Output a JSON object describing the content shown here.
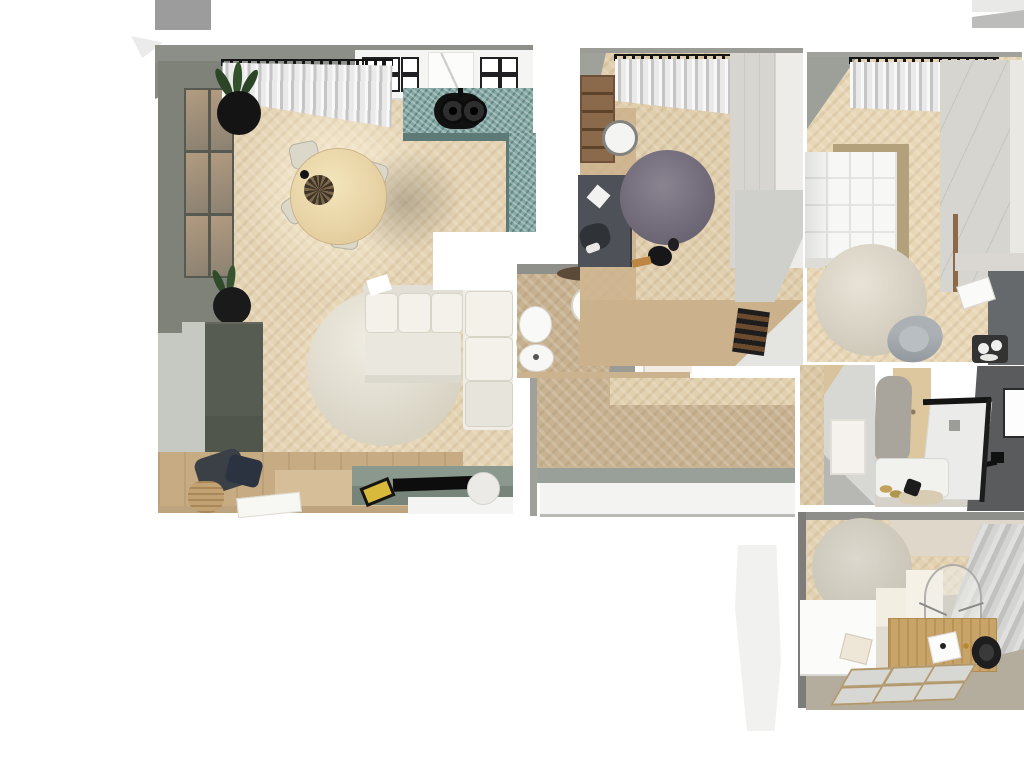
{
  "palette": {
    "bg": "#ffffff",
    "wall-gray": "#8c8f87",
    "wall-dark": "#7f8279",
    "wall-light": "#c6c8c2",
    "floor-beige": "#e5d4b4",
    "floor-tan": "#c8b291",
    "floor-dark": "#cbb28c",
    "floor-taupe": "#b4ad9e",
    "counter-teal": "#85a7a4",
    "counter-edge": "#5e7a77",
    "sofa-white": "#efede5",
    "rug-purple": "#7a7380",
    "tv-top": "#8a988e",
    "tv-front": "#76847a",
    "cabinet-dark": "#575c52",
    "wood-shelf": "#8a6a4a",
    "desk-dark": "#4e5157",
    "desk-wood": "#c8a469",
    "dark-wall": "#595b5d",
    "wardrobe-gray": "#d7d5d0",
    "bed-khaki": "#b2a17a",
    "duvet-white": "#f7f7f5",
    "black": "#141414"
  },
  "scene": {
    "type": "apartment-3d-floorplan-top-view",
    "rooms": [
      {
        "name": "living-room-with-kitchen",
        "furniture": [
          "windows",
          "curtain",
          "kitchen-cabinets",
          "fridge",
          "ovens",
          "teal-countertop",
          "double-sink",
          "dining-table",
          "dining-chairs",
          "centerpiece",
          "potted-plants",
          "tall-cabinet",
          "corner-sofa",
          "round-rug",
          "tv-sideboard",
          "tv",
          "game-console",
          "sphere-lamp",
          "basket",
          "bags",
          "papers"
        ]
      },
      {
        "name": "bathroom-small",
        "furniture": [
          "washbasin",
          "toilet",
          "bidet",
          "bath-mat",
          "door"
        ]
      },
      {
        "name": "kids-room",
        "furniture": [
          "curtain",
          "bookshelf",
          "wall-clock",
          "desk",
          "round-purple-rug",
          "wardrobe",
          "shoe-rack",
          "pouf"
        ]
      },
      {
        "name": "bedroom",
        "furniture": [
          "curtain",
          "double-bed",
          "round-rug",
          "armchair",
          "wardrobe",
          "desk",
          "papers",
          "tray"
        ]
      },
      {
        "name": "bathroom-shower",
        "furniture": [
          "walk-in-shower",
          "glass-screen",
          "bathtub",
          "towel",
          "mirror",
          "slippers",
          "bath-mat"
        ]
      },
      {
        "name": "hallway",
        "furniture": [
          "sideboard"
        ]
      },
      {
        "name": "study",
        "furniture": [
          "round-rug",
          "roller-blind",
          "easel",
          "pedestals",
          "wooden-desk",
          "ghost-chair",
          "stool",
          "picture-frames"
        ]
      }
    ]
  }
}
